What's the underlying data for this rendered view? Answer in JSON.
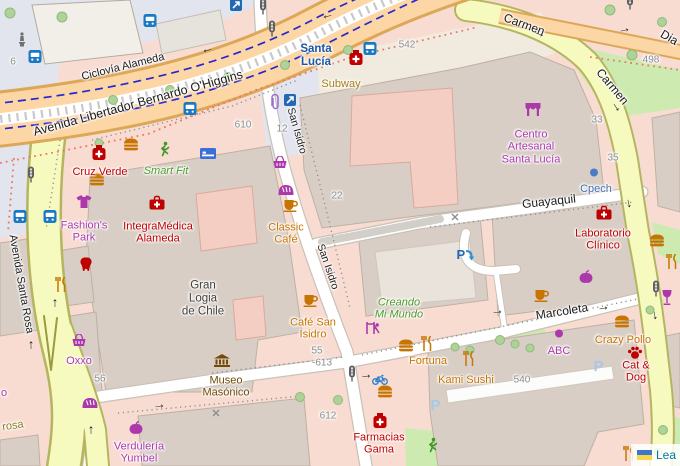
{
  "attribution": {
    "flag_icon": "ukraine-flag-icon",
    "link_text": "Lea"
  },
  "streets": [
    {
      "name": "ciclovia-alameda",
      "label": "Ciclovía Alameda",
      "x": 123,
      "y": 67,
      "rot": -14,
      "size": 11
    },
    {
      "name": "avenida-ohiggins",
      "label": "Avenida Libertador Bernardo O'Higgins",
      "x": 138,
      "y": 103,
      "rot": -15.5,
      "size": 12.5
    },
    {
      "name": "carmen-north",
      "label": "Carmen",
      "x": 524,
      "y": 25,
      "rot": 20,
      "size": 12
    },
    {
      "name": "carmen-east",
      "label": "Carmen",
      "x": 612,
      "y": 87,
      "rot": 50,
      "size": 12
    },
    {
      "name": "diagonal",
      "label": "Dia",
      "x": 669,
      "y": 38,
      "rot": 30,
      "size": 12
    },
    {
      "name": "guayaquil",
      "label": "Guayaquil",
      "x": 549,
      "y": 202,
      "rot": -6,
      "size": 12
    },
    {
      "name": "marcoleta",
      "label": "Marcoleta",
      "x": 562,
      "y": 312,
      "rot": -9,
      "size": 12
    },
    {
      "name": "san-isidro-north",
      "label": "San Isidro",
      "x": 296,
      "y": 131,
      "rot": 74,
      "size": 10.5
    },
    {
      "name": "san-isidro-south",
      "label": "San Isidro",
      "x": 327,
      "y": 267,
      "rot": 71,
      "size": 10.5
    },
    {
      "name": "avenida-santa-rosa",
      "label": "Avenida Santa Rosa",
      "x": 21,
      "y": 284,
      "rot": 80,
      "size": 11
    },
    {
      "name": "rosa",
      "label": "rosa",
      "x": 13,
      "y": 426,
      "rot": -8,
      "size": 11,
      "color": "#8d7c1e"
    }
  ],
  "house_numbers": [
    {
      "label": "6",
      "x": 13,
      "y": 62
    },
    {
      "label": "610",
      "x": 243,
      "y": 125
    },
    {
      "label": "12",
      "x": 282,
      "y": 129
    },
    {
      "label": "542",
      "x": 407,
      "y": 45
    },
    {
      "label": "498",
      "x": 651,
      "y": 60
    },
    {
      "label": "33",
      "x": 597,
      "y": 120
    },
    {
      "label": "35",
      "x": 613,
      "y": 158
    },
    {
      "label": "22",
      "x": 337,
      "y": 196
    },
    {
      "label": "56",
      "x": 100,
      "y": 379
    },
    {
      "label": "55",
      "x": 317,
      "y": 351
    },
    {
      "label": "-613",
      "x": 322,
      "y": 363
    },
    {
      "label": "612",
      "x": 328,
      "y": 416
    },
    {
      "label": "540",
      "x": 522,
      "y": 380
    }
  ],
  "pois": [
    {
      "name": "poi-santa-lucia-station",
      "label": "Santa\nLucía",
      "x": 316,
      "y": 56,
      "color": "station",
      "size": 11.5
    },
    {
      "name": "poi-subway",
      "label": "Subway",
      "x": 341,
      "y": 84,
      "color": "gold",
      "size": 11
    },
    {
      "name": "poi-cruz-verde",
      "label": "Cruz Verde",
      "x": 100,
      "y": 172,
      "color": "health",
      "size": 11
    },
    {
      "name": "poi-smart-fit",
      "label": "Smart Fit",
      "x": 166,
      "y": 171,
      "color": "leisure",
      "size": 11
    },
    {
      "name": "poi-fashions-park",
      "label": "Fashion's\nPark",
      "x": 84,
      "y": 232,
      "color": "shop",
      "size": 11
    },
    {
      "name": "poi-integramedica",
      "label": "IntegraMédica\nAlameda",
      "x": 158,
      "y": 233,
      "color": "health",
      "size": 11
    },
    {
      "name": "poi-gran-logia",
      "label": "Gran\nLogia\nde Chile",
      "x": 203,
      "y": 299,
      "color": "dark",
      "size": 11.5
    },
    {
      "name": "poi-classic-cafe",
      "label": "Classic\nCafé",
      "x": 286,
      "y": 234,
      "color": "food",
      "size": 11
    },
    {
      "name": "poi-cafe-san-isidro",
      "label": "Café San\nIsidro",
      "x": 313,
      "y": 329,
      "color": "food",
      "size": 11
    },
    {
      "name": "poi-museo-masonico",
      "label": "Museo\nMasónico",
      "x": 226,
      "y": 387,
      "color": "museum",
      "size": 11
    },
    {
      "name": "poi-oxxo",
      "label": "Oxxo",
      "x": 79,
      "y": 361,
      "color": "shop",
      "size": 11
    },
    {
      "name": "poi-verduleria-yumbel",
      "label": "Verdulería\nYumbel",
      "x": 139,
      "y": 453,
      "color": "shop",
      "size": 11
    },
    {
      "name": "poi-farmacias-gama",
      "label": "Farmacias\nGama",
      "x": 379,
      "y": 444,
      "color": "health",
      "size": 11
    },
    {
      "name": "poi-creando-mi-mundo",
      "label": "Creando\nMi Mundo",
      "x": 399,
      "y": 309,
      "color": "leisure",
      "size": 11
    },
    {
      "name": "poi-fortuna",
      "label": "Fortuna",
      "x": 428,
      "y": 361,
      "color": "food",
      "size": 11
    },
    {
      "name": "poi-kami-sushi",
      "label": "Kami Sushi",
      "x": 466,
      "y": 380,
      "color": "food",
      "size": 11
    },
    {
      "name": "poi-abc",
      "label": "ABC",
      "x": 559,
      "y": 351,
      "color": "shop",
      "size": 11
    },
    {
      "name": "poi-crazy-pollo",
      "label": "Crazy Pollo",
      "x": 623,
      "y": 340,
      "color": "food",
      "size": 11
    },
    {
      "name": "poi-cat-and-dog",
      "label": "Cat & Dog",
      "x": 636,
      "y": 372,
      "color": "health",
      "size": 11
    },
    {
      "name": "poi-centro-artesanal",
      "label": "Centro\nArtesanal\nSanta Lucía",
      "x": 531,
      "y": 147,
      "color": "shop",
      "size": 11
    },
    {
      "name": "poi-cpech",
      "label": "Cpech",
      "x": 596,
      "y": 189,
      "color": "office",
      "size": 11
    },
    {
      "name": "poi-laboratorio-clinico",
      "label": "Laboratorio\nClínico",
      "x": 603,
      "y": 240,
      "color": "health",
      "size": 11
    },
    {
      "name": "poi-partial",
      "label": "o",
      "x": 4,
      "y": 393,
      "color": "shop",
      "size": 11
    }
  ],
  "arrows": [
    {
      "glyph": "←",
      "x": 207,
      "y": 48,
      "rot": -14
    },
    {
      "glyph": "←",
      "x": 327,
      "y": 14,
      "rot": -14
    },
    {
      "glyph": "→",
      "x": 624,
      "y": 28,
      "rot": -12
    },
    {
      "glyph": "→",
      "x": 540,
      "y": 32,
      "rot": 22
    },
    {
      "glyph": "→",
      "x": 618,
      "y": 106,
      "rot": 55
    },
    {
      "glyph": "→",
      "x": 631,
      "y": 203,
      "rot": 78
    },
    {
      "glyph": "→",
      "x": 657,
      "y": 315,
      "rot": 80
    },
    {
      "glyph": "→",
      "x": 603,
      "y": 306,
      "rot": -9
    },
    {
      "glyph": "↑",
      "x": 55,
      "y": 302,
      "rot": 0
    },
    {
      "glyph": "↑",
      "x": 31,
      "y": 344,
      "rot": 0
    },
    {
      "glyph": "↑",
      "x": 91,
      "y": 429,
      "rot": 0
    },
    {
      "glyph": "→",
      "x": 159,
      "y": 404,
      "rot": -7
    },
    {
      "glyph": "→",
      "x": 366,
      "y": 374,
      "rot": -5
    },
    {
      "glyph": "→",
      "x": 497,
      "y": 310,
      "rot": -8
    }
  ],
  "icons": [
    {
      "name": "pharmacy-icon",
      "type": "jar",
      "x": 99,
      "y": 155
    },
    {
      "name": "pharmacy-icon",
      "type": "jar",
      "x": 356,
      "y": 60
    },
    {
      "name": "pharmacy-icon",
      "type": "jar",
      "x": 380,
      "y": 423
    },
    {
      "name": "clinic-icon",
      "type": "bag",
      "x": 157,
      "y": 205
    },
    {
      "name": "clinic-icon",
      "type": "bag",
      "x": 604,
      "y": 215
    },
    {
      "name": "fast-food-icon",
      "type": "burger",
      "x": 131,
      "y": 147
    },
    {
      "name": "fast-food-icon",
      "type": "burger",
      "x": 97,
      "y": 182
    },
    {
      "name": "fast-food-icon",
      "type": "burger",
      "x": 406,
      "y": 348
    },
    {
      "name": "fast-food-icon",
      "type": "burger",
      "x": 385,
      "y": 394
    },
    {
      "name": "fast-food-icon",
      "type": "burger",
      "x": 622,
      "y": 324
    },
    {
      "name": "fast-food-icon",
      "type": "burger",
      "x": 657,
      "y": 243
    },
    {
      "name": "restaurant-icon",
      "type": "cutlery",
      "x": 61,
      "y": 287
    },
    {
      "name": "restaurant-icon",
      "type": "cutlery",
      "x": 427,
      "y": 346
    },
    {
      "name": "restaurant-icon",
      "type": "cutlery",
      "x": 469,
      "y": 361
    },
    {
      "name": "restaurant-icon",
      "type": "cutlery",
      "x": 672,
      "y": 264
    },
    {
      "name": "restaurant-icon",
      "type": "cutlery",
      "x": 629,
      "y": 456
    },
    {
      "name": "cafe-icon",
      "type": "cup",
      "x": 291,
      "y": 208
    },
    {
      "name": "cafe-icon",
      "type": "cup",
      "x": 311,
      "y": 303
    },
    {
      "name": "cafe-icon",
      "type": "cup",
      "x": 542,
      "y": 298
    },
    {
      "name": "clothes-icon",
      "type": "tshirt",
      "x": 84,
      "y": 204
    },
    {
      "name": "dentist-icon",
      "type": "tooth",
      "x": 86,
      "y": 267
    },
    {
      "name": "hostel-icon",
      "type": "bed",
      "x": 208,
      "y": 155
    },
    {
      "name": "fitness-icon",
      "type": "runner",
      "x": 164,
      "y": 152
    },
    {
      "name": "fitness-icon",
      "type": "runner",
      "x": 432,
      "y": 448
    },
    {
      "name": "convenience-icon",
      "type": "basket",
      "x": 79,
      "y": 343
    },
    {
      "name": "convenience-icon",
      "type": "basket",
      "x": 280,
      "y": 165
    },
    {
      "name": "bakery-icon",
      "type": "bread",
      "x": 286,
      "y": 191
    },
    {
      "name": "bakery-icon",
      "type": "bread",
      "x": 90,
      "y": 404
    },
    {
      "name": "greengrocer-icon",
      "type": "apple",
      "x": 136,
      "y": 430
    },
    {
      "name": "greengrocer-icon",
      "type": "apple",
      "x": 586,
      "y": 279
    },
    {
      "name": "museum-icon",
      "type": "museum",
      "x": 222,
      "y": 363
    },
    {
      "name": "marketplace-icon",
      "type": "stall",
      "x": 533,
      "y": 112
    },
    {
      "name": "playground-icon",
      "type": "playground",
      "x": 373,
      "y": 330
    },
    {
      "name": "pet-shop-icon",
      "type": "paw",
      "x": 635,
      "y": 355
    },
    {
      "name": "stationery-icon",
      "type": "paperclip",
      "x": 275,
      "y": 105
    },
    {
      "name": "bar-icon",
      "type": "wine",
      "x": 667,
      "y": 300
    },
    {
      "name": "office-dot-icon",
      "type": "dot-blue",
      "x": 594,
      "y": 173
    },
    {
      "name": "shop-dot-icon",
      "type": "dot-purple",
      "x": 559,
      "y": 334
    },
    {
      "name": "bus-stop-icon",
      "type": "bus",
      "x": 35,
      "y": 59
    },
    {
      "name": "tram-stop-icon",
      "type": "bus",
      "x": 150,
      "y": 23
    },
    {
      "name": "bus-stop-icon",
      "type": "bus",
      "x": 190,
      "y": 111
    },
    {
      "name": "bus-stop-icon",
      "type": "bus",
      "x": 20,
      "y": 219
    },
    {
      "name": "bus-stop-icon",
      "type": "bus",
      "x": 50,
      "y": 219
    },
    {
      "name": "bus-stop-icon",
      "type": "bus",
      "x": 370,
      "y": 51
    },
    {
      "name": "subway-entrance-icon",
      "type": "entrance",
      "x": 236,
      "y": 7
    },
    {
      "name": "subway-entrance-icon",
      "type": "entrance",
      "x": 290,
      "y": 102
    },
    {
      "name": "traffic-signal-icon",
      "type": "light",
      "x": 263,
      "y": 9
    },
    {
      "name": "traffic-signal-icon",
      "type": "light",
      "x": 272,
      "y": 31
    },
    {
      "name": "traffic-signal-icon",
      "type": "light",
      "x": 31,
      "y": 177
    },
    {
      "name": "traffic-signal-icon",
      "type": "light",
      "x": 352,
      "y": 376
    },
    {
      "name": "traffic-signal-icon",
      "type": "light",
      "x": 656,
      "y": 291
    },
    {
      "name": "traffic-signal-icon",
      "type": "light",
      "x": 630,
      "y": 4
    },
    {
      "name": "bicycle-parking-icon",
      "type": "bike",
      "x": 380,
      "y": 381
    },
    {
      "name": "parking-entrance-icon",
      "type": "p-entrance",
      "x": 466,
      "y": 257
    },
    {
      "name": "parking-icon",
      "type": "p-faded",
      "x": 600,
      "y": 368
    },
    {
      "name": "parking-icon",
      "type": "p-faded",
      "x": 437,
      "y": 407
    },
    {
      "name": "monument-icon",
      "type": "statue",
      "x": 22,
      "y": 42
    },
    {
      "name": "gate-icon",
      "type": "gate",
      "x": 455,
      "y": 217
    },
    {
      "name": "gate-icon",
      "type": "gate",
      "x": 216,
      "y": 413
    }
  ]
}
